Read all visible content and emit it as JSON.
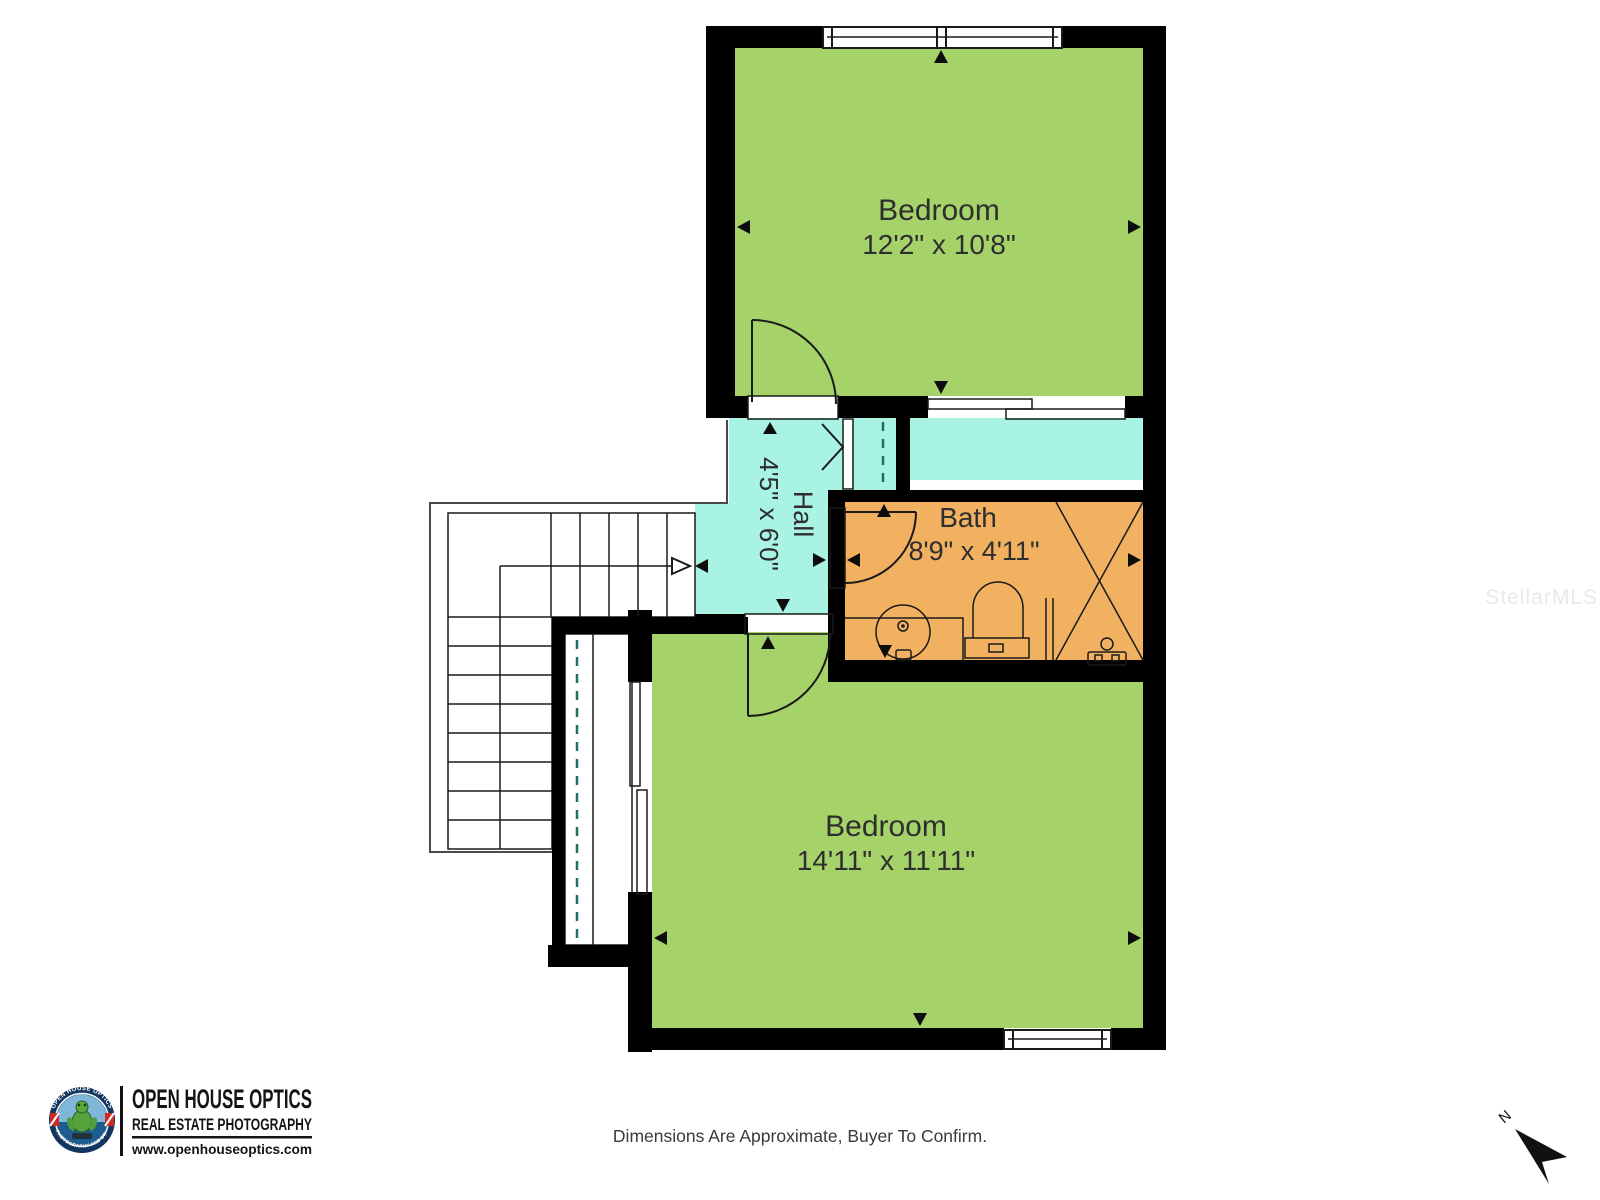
{
  "plan": {
    "colors": {
      "room_green": "#a5d36a",
      "floor_cyan": "#a9f3e4",
      "bath_orange": "#f1b160",
      "wall": "#000000"
    },
    "rooms": [
      {
        "name": "Bedroom",
        "dimensions": "12'2\" x 10'8\""
      },
      {
        "name": "Hall",
        "dimensions": "4'5\" x 6'0\""
      },
      {
        "name": "Bath",
        "dimensions": "8'9\" x 4'11\""
      },
      {
        "name": "Bedroom",
        "dimensions": "14'11\" x 11'11\""
      }
    ],
    "compass_label": "N"
  },
  "footer": {
    "disclaimer": "Dimensions Are Approximate, Buyer To Confirm."
  },
  "watermark": {
    "text": "StellarMLS"
  },
  "logo": {
    "badge_top": "OPEN HOUSE OPTICS",
    "badge_bottom": "3D PHOTOGRAPHY AND DRONE",
    "title": "OPEN HOUSE OPTICS",
    "subtitle": "REAL ESTATE PHOTOGRAPHY",
    "website": "www.openhouseoptics.com"
  }
}
